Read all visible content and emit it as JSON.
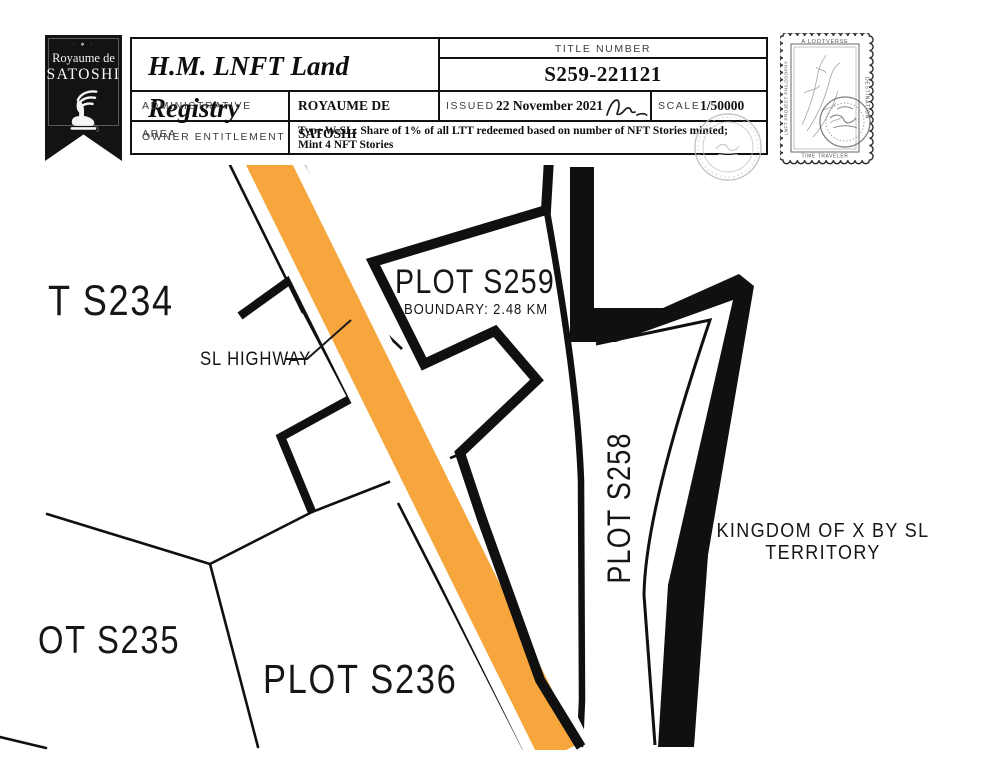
{
  "badge": {
    "ornament": "· ❖ ·",
    "kingdom_line1": "Royaume de",
    "kingdom_line2": "SATOSHI"
  },
  "header": {
    "title": "H.M. LNFT Land Registry",
    "title_number_label": "TITLE NUMBER",
    "title_number": "S259-221121",
    "admin_area_label": "ADMINISTRATIVE AREA",
    "admin_area": "ROYAUME DE SATOSHI",
    "issued_label": "ISSUED",
    "issued_date": "22 November 2021",
    "scale_label": "SCALE",
    "scale_value": "1/50000",
    "owner_label": "OWNER ENTITLEMENT",
    "entitlement_line1": "Type W-SL: Share of 1% of all LTT redeemed based on number of NFT Stories minted;",
    "entitlement_line2": "Mint 4 NFT Stories"
  },
  "stamp": {
    "top": "A LOOTVERSE",
    "right": "DESTINATION",
    "left": "LNFT PROJECT PHILOSOPHY",
    "bottom": "TIME TRAVELER"
  },
  "map": {
    "labels": {
      "plot_s234": "T S234",
      "plot_s235": "OT S235",
      "plot_s236": "PLOT S236",
      "plot_s259": "PLOT S259",
      "plot_s259_boundary": "BOUNDARY: 2.48 KM",
      "plot_s258": "PLOT S258",
      "highway": "SL HIGHWAY",
      "territory_line1": "KINGDOM OF X BY SL",
      "territory_line2": "TERRITORY"
    },
    "colors": {
      "road": "#F6A63C",
      "ink": "#101010"
    }
  }
}
